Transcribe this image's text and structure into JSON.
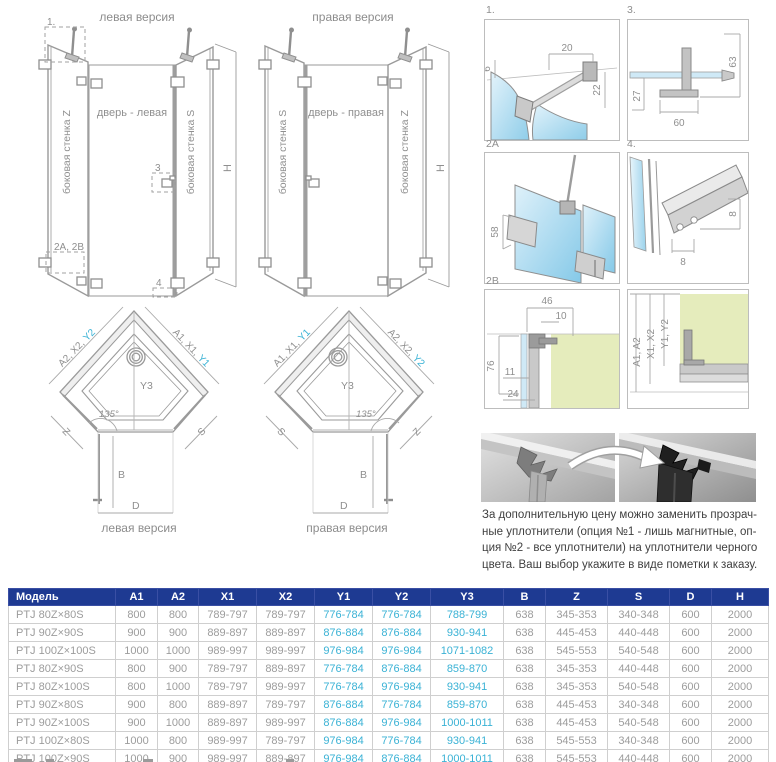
{
  "colors": {
    "accent_cyan": "#3ab2d5",
    "table_header_bg": "#1e3a92",
    "glass_blue": "#cfe9f6",
    "wall_green": "#e5ecbc",
    "line_gray": "#9a9a9a"
  },
  "elevations": {
    "left": {
      "title": "левая версия",
      "side_wall_left": "боковая стенка Z",
      "door": "дверь - левая",
      "side_wall_right": "боковая стенка S",
      "height_label": "H",
      "callout_1": "1.",
      "callout_2": "2A, 2B",
      "callout_3": "3",
      "callout_4": "4"
    },
    "right": {
      "title": "правая версия",
      "side_wall_left": "боковая стенка S",
      "door": "дверь - правая",
      "side_wall_right": "боковая стенка Z",
      "height_label": "H"
    }
  },
  "plans": {
    "left": {
      "caption": "левая версия",
      "diag_left_prefix": "A2, X2,",
      "diag_left_hl": "Y2",
      "diag_right_prefix": "A1, X1,",
      "diag_right_hl": "Y1",
      "center_label": "Y3",
      "angle_label": "135°",
      "edge_left": "Z",
      "edge_right": "S",
      "depth_label": "B",
      "width_label": "D"
    },
    "right": {
      "caption": "правая версия",
      "diag_left_prefix": "A1, X1,",
      "diag_left_hl": "Y1",
      "diag_right_prefix": "A2, X2,",
      "diag_right_hl": "Y2",
      "center_label": "Y3",
      "angle_label": "135°",
      "edge_left": "S",
      "edge_right": "Z",
      "depth_label": "B",
      "width_label": "D"
    }
  },
  "details": {
    "d1": {
      "label": "1.",
      "dim_top": "20",
      "dim_left": "6",
      "dim_right": "22"
    },
    "d3": {
      "label": "3.",
      "dim_right": "63",
      "dim_left": "27",
      "dim_bottom": "60"
    },
    "d2a": {
      "label": "2A",
      "dim_left": "58"
    },
    "d4": {
      "label": "4.",
      "dim_right": "8",
      "dim_bottom": "8"
    },
    "d2b": {
      "label": "2B",
      "dim_top": "46",
      "dim_top2": "10",
      "dim_left": "76",
      "dim_left2": "11",
      "dim_left3": "24"
    },
    "d6": {
      "dim_a": "A1, A2",
      "dim_x": "X1, X2",
      "dim_y": "Y1, Y2"
    }
  },
  "seal_note": {
    "lines": [
      "За дополнительную цену можно заменить прозрач-",
      "ные уплотнители (опция №1 - лишь магнитные, оп-",
      "ция №2 - все уплотнители) на уплотнители черного",
      "цвета. Ваш выбор укажите в виде пометки к заказу."
    ]
  },
  "table": {
    "headers": [
      "Модель",
      "A1",
      "A2",
      "X1",
      "X2",
      "Y1",
      "Y2",
      "Y3",
      "B",
      "Z",
      "S",
      "D",
      "H"
    ],
    "highlight_columns": [
      5,
      6,
      7
    ],
    "rows": [
      [
        "PTJ 80Z×80S",
        "800",
        "800",
        "789-797",
        "789-797",
        "776-784",
        "776-784",
        "788-799",
        "638",
        "345-353",
        "340-348",
        "600",
        "2000"
      ],
      [
        "PTJ 90Z×90S",
        "900",
        "900",
        "889-897",
        "889-897",
        "876-884",
        "876-884",
        "930-941",
        "638",
        "445-453",
        "440-448",
        "600",
        "2000"
      ],
      [
        "PTJ 100Z×100S",
        "1000",
        "1000",
        "989-997",
        "989-997",
        "976-984",
        "976-984",
        "1071-1082",
        "638",
        "545-553",
        "540-548",
        "600",
        "2000"
      ],
      [
        "PTJ 80Z×90S",
        "800",
        "900",
        "789-797",
        "889-897",
        "776-784",
        "876-884",
        "859-870",
        "638",
        "345-353",
        "440-448",
        "600",
        "2000"
      ],
      [
        "PTJ 80Z×100S",
        "800",
        "1000",
        "789-797",
        "989-997",
        "776-784",
        "976-984",
        "930-941",
        "638",
        "345-353",
        "540-548",
        "600",
        "2000"
      ],
      [
        "PTJ 90Z×80S",
        "900",
        "800",
        "889-897",
        "789-797",
        "876-884",
        "776-784",
        "859-870",
        "638",
        "445-453",
        "340-348",
        "600",
        "2000"
      ],
      [
        "PTJ 90Z×100S",
        "900",
        "1000",
        "889-897",
        "989-997",
        "876-884",
        "976-984",
        "1000-1011",
        "638",
        "445-453",
        "540-548",
        "600",
        "2000"
      ],
      [
        "PTJ 100Z×80S",
        "1000",
        "800",
        "989-997",
        "789-797",
        "976-984",
        "776-784",
        "930-941",
        "638",
        "545-553",
        "340-348",
        "600",
        "2000"
      ],
      [
        "PTJ 100Z×90S",
        "1000",
        "900",
        "989-997",
        "889-897",
        "976-984",
        "876-884",
        "1000-1011",
        "638",
        "545-553",
        "440-448",
        "600",
        "2000"
      ]
    ]
  }
}
